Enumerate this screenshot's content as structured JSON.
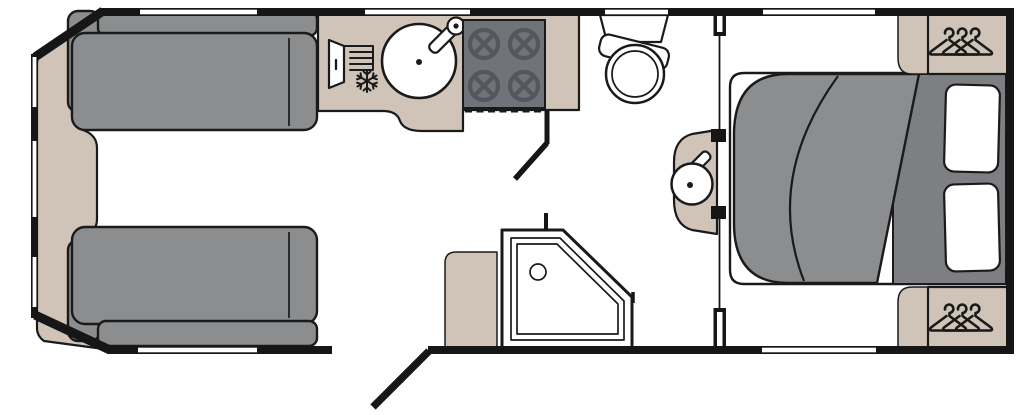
{
  "diagram_type": "caravan-floorplan",
  "rooms": [
    "front-lounge",
    "kitchen",
    "washroom",
    "rear-bedroom"
  ],
  "colors": {
    "wall": "#161616",
    "floor": "#ffffff",
    "outline": "#1a1a1a",
    "upholstery": "#8b8d8f",
    "bed_base": "#7d7f82",
    "worktop": "#cfc4b7",
    "hob": "#70737a",
    "hob_burner": "#54575d"
  },
  "labels": {
    "front_chest": "Front chest",
    "sofa_top": "Sofa",
    "sofa_bottom": "Sofa",
    "worktop": "Kitchen worktop",
    "fridge": "Fridge",
    "sink": "Kitchen sink",
    "hob": "Four-burner hob",
    "worktop_flap": "Worktop flap",
    "bathroom_door": "Washroom door",
    "toilet": "Toilet",
    "washbasin": "Washbasin",
    "shower": "Shower",
    "shower_cabinet": "Cabinet",
    "bed": "Island bed",
    "duvet": "Duvet",
    "pillow": "Pillow",
    "wardrobe_top": "Wardrobe",
    "wardrobe_bottom": "Wardrobe",
    "shelf": "Bedside unit",
    "entrance_door": "Entrance door",
    "window": "Window",
    "partition": "Partition wall"
  }
}
